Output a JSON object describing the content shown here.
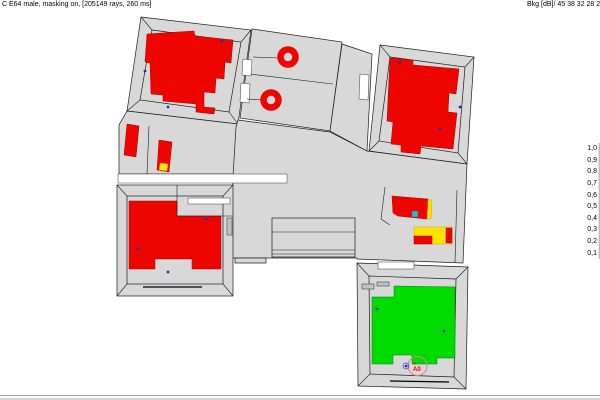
{
  "header": {
    "left": "C E64 male, masking on,  [205149 rays, 260 ms]",
    "right": "Bkg [dB]/ 45 38 32 28 25 23"
  },
  "legend": {
    "values": [
      "1,0",
      "0,9",
      "0,8",
      "0,7",
      "0,6",
      "0,5",
      "0,4",
      "0,3",
      "0,2",
      "0,1"
    ]
  },
  "source_marker": {
    "label": "A0"
  },
  "colors": {
    "floor_gray": "#d8d8d8",
    "map_red": "#ee0500",
    "map_yellow": "#ffe400",
    "map_cyan": "#29b8c8",
    "map_green": "#00dc00",
    "receiver_blue": "#2a2ab8",
    "source_ring": "#cc8a8a",
    "source_text": "#dd0000"
  },
  "markers": {
    "receivers": [
      {
        "x": 145,
        "y": 71
      },
      {
        "x": 168,
        "y": 107
      },
      {
        "x": 222,
        "y": 41
      },
      {
        "x": 400,
        "y": 63
      },
      {
        "x": 460,
        "y": 107
      },
      {
        "x": 440,
        "y": 129
      },
      {
        "x": 206,
        "y": 219
      },
      {
        "x": 138,
        "y": 249
      },
      {
        "x": 168,
        "y": 272
      },
      {
        "x": 377,
        "y": 309
      },
      {
        "x": 444,
        "y": 331
      },
      {
        "x": 406,
        "y": 366
      }
    ],
    "source": {
      "x": 417.5,
      "y": 366
    }
  }
}
